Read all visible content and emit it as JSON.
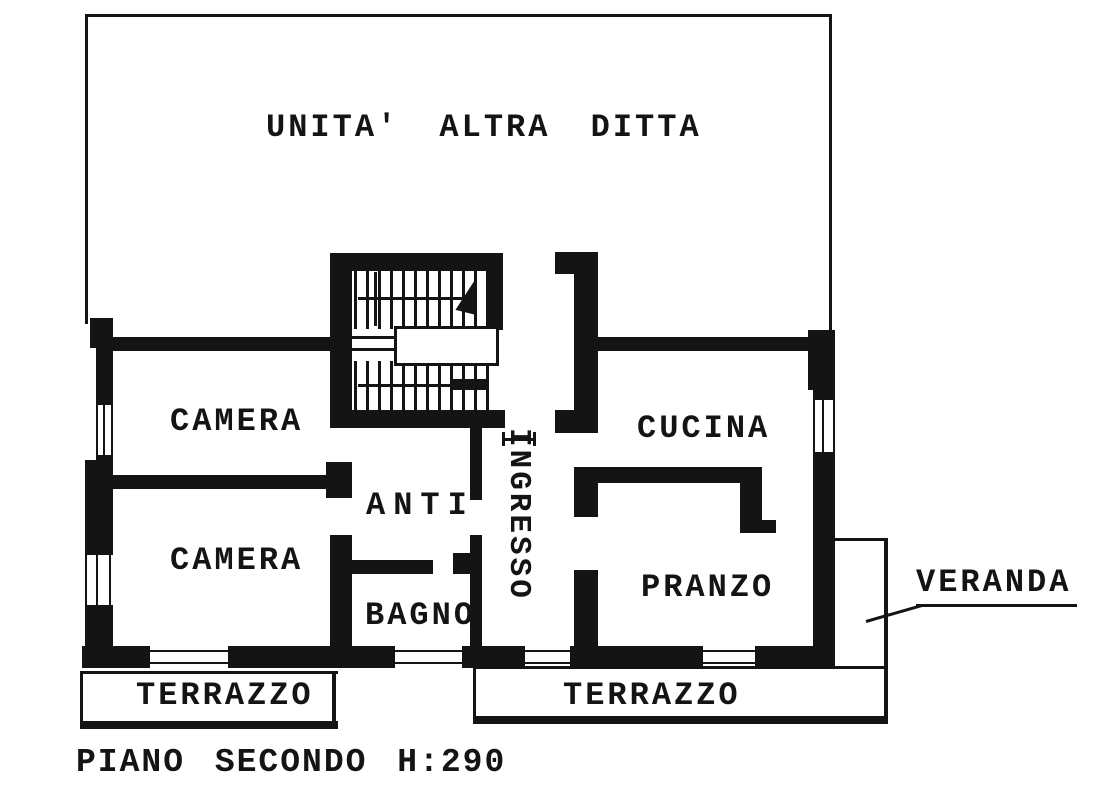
{
  "title": "UNITA' ALTRA DITTA",
  "caption": "PIANO SECONDO H:290",
  "rooms": {
    "camera_upper": "CAMERA",
    "camera_lower": "CAMERA",
    "anti": "ANTI",
    "bagno": "BAGNO",
    "ingresso": "INGRESSO",
    "cucina": "CUCINA",
    "pranzo": "PRANZO",
    "veranda": "VERANDA",
    "terrazzo_left": "TERRAZZO",
    "terrazzo_right": "TERRAZZO"
  },
  "colors": {
    "ink": "#141414",
    "paper": "#ffffff"
  }
}
